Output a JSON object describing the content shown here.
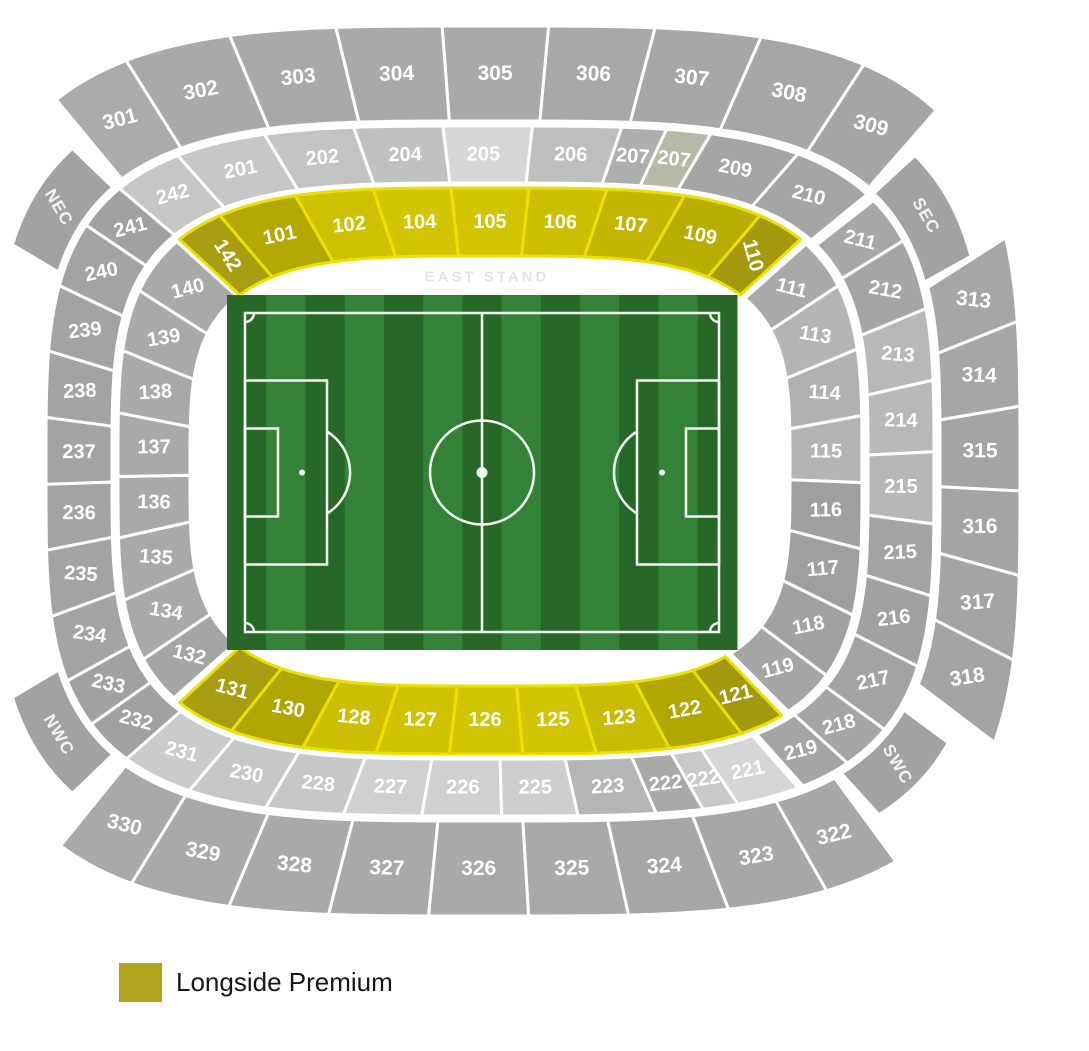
{
  "legend": {
    "label": "Longside Premium",
    "color": "#b1a31d"
  },
  "stand_label": "EAST STAND",
  "stadium": {
    "center": [
      490,
      471
    ],
    "exp": 0.55,
    "section_stroke": "#ffffff",
    "premium_stroke": "#ece000",
    "corner_color": "#a2a2a2",
    "corner_rotation": 60,
    "rings": {
      "inner": {
        "r0": [
          300,
          215
        ],
        "r1": [
          372,
          283
        ]
      },
      "middle": {
        "r0": [
          378,
          288
        ],
        "r1": [
          444,
          345
        ]
      },
      "outer": {
        "r0": [
          450,
          350
        ],
        "r1": [
          530,
          445
        ]
      },
      "corner": {
        "r0": [
          448,
          350
        ],
        "r1": [
          496,
          398
        ]
      }
    },
    "bands": [
      {
        "name": "top-outer",
        "ring": "outer",
        "t0": -134,
        "t1": -43,
        "fs": 21,
        "sections": [
          {
            "n": "301",
            "w": 0.75,
            "c": "#ababab"
          },
          {
            "n": "302",
            "w": 1,
            "c": "#a9a9a9"
          },
          {
            "n": "303",
            "w": 1,
            "c": "#a9a9a9"
          },
          {
            "n": "304",
            "w": 1,
            "c": "#a9a9a9"
          },
          {
            "n": "305",
            "w": 1,
            "c": "#a9a9a9"
          },
          {
            "n": "306",
            "w": 1,
            "c": "#a8a8a8"
          },
          {
            "n": "307",
            "w": 1,
            "c": "#a7a7a7"
          },
          {
            "n": "308",
            "w": 1,
            "c": "#a6a6a6"
          },
          {
            "n": "309",
            "w": 0.8,
            "c": "#a5a5a5"
          }
        ]
      },
      {
        "name": "right-outer",
        "ring": "outer",
        "t0": -18,
        "t1": 24,
        "fs": 21,
        "sections": [
          {
            "n": "313",
            "w": 1,
            "c": "#a6a6a6"
          },
          {
            "n": "314",
            "w": 1,
            "c": "#a6a6a6"
          },
          {
            "n": "315",
            "w": 1,
            "c": "#a4a4a4"
          },
          {
            "n": "316",
            "w": 1,
            "c": "#a4a4a4"
          },
          {
            "n": "317",
            "w": 1,
            "c": "#a4a4a4"
          },
          {
            "n": "318",
            "w": 1,
            "c": "#a4a4a4"
          }
        ]
      },
      {
        "name": "bottom-outer",
        "ring": "outer",
        "t0": 52,
        "t1": 133,
        "fs": 21,
        "sections": [
          {
            "n": "322",
            "w": 0.75,
            "c": "#a7a7a7"
          },
          {
            "n": "323",
            "w": 1,
            "c": "#a7a7a7"
          },
          {
            "n": "324",
            "w": 1,
            "c": "#a6a6a6"
          },
          {
            "n": "325",
            "w": 1,
            "c": "#a9a9a9"
          },
          {
            "n": "326",
            "w": 1,
            "c": "#a9a9a9"
          },
          {
            "n": "327",
            "w": 1,
            "c": "#a9a9a9"
          },
          {
            "n": "328",
            "w": 1,
            "c": "#a9a9a9"
          },
          {
            "n": "329",
            "w": 1,
            "c": "#a9a9a9"
          },
          {
            "n": "330",
            "w": 0.8,
            "c": "#a9a9a9"
          }
        ]
      },
      {
        "name": "top-middle",
        "ring": "middle",
        "t0": -136,
        "t1": -42,
        "fs": 20,
        "sections": [
          {
            "n": "242",
            "w": 0.75,
            "c": "#c6c6c6"
          },
          {
            "n": "201",
            "w": 1,
            "c": "#c7c7c7"
          },
          {
            "n": "202",
            "w": 1,
            "c": "#c3c3c3"
          },
          {
            "n": "204",
            "w": 1,
            "c": "#c1c1c1"
          },
          {
            "n": "205",
            "w": 1,
            "c": "#d6d6d6"
          },
          {
            "n": "206",
            "w": 1,
            "c": "#bebebe"
          },
          {
            "n": "207",
            "w": 0.5,
            "c": "#aeaeae"
          },
          {
            "n": "207",
            "w": 0.5,
            "c": "#b8b8a6"
          },
          {
            "n": "209",
            "w": 1,
            "c": "#a5a5a5"
          },
          {
            "n": "210",
            "w": 0.9,
            "c": "#a5a5a5"
          }
        ]
      },
      {
        "name": "right-middle",
        "ring": "middle",
        "t0": -40,
        "t1": 58,
        "fs": 20,
        "sections": [
          {
            "n": "211",
            "w": 0.7,
            "c": "#a7a7a7"
          },
          {
            "n": "212",
            "w": 1,
            "c": "#a5a5a5"
          },
          {
            "n": "213",
            "w": 1,
            "c": "#b8b8b8"
          },
          {
            "n": "214",
            "w": 1,
            "c": "#b8b8b8"
          },
          {
            "n": "215",
            "w": 1,
            "c": "#b6b6b6"
          },
          {
            "n": "215",
            "w": 1,
            "c": "#a3a3a3"
          },
          {
            "n": "216",
            "w": 1,
            "c": "#a1a1a1"
          },
          {
            "n": "217",
            "w": 1,
            "c": "#a3a3a3"
          },
          {
            "n": "218",
            "w": 0.7,
            "c": "#a5a5a5"
          },
          {
            "n": "219",
            "w": 0.7,
            "c": "#a5a5a5"
          }
        ]
      },
      {
        "name": "bottom-middle",
        "ring": "middle",
        "t0": 59,
        "t1": 134,
        "fs": 20,
        "sections": [
          {
            "n": "221",
            "w": 0.8,
            "c": "#d5d5d5"
          },
          {
            "n": "222",
            "w": 0.45,
            "c": "#c9c9c9"
          },
          {
            "n": "222",
            "w": 0.6,
            "c": "#a9a9a9"
          },
          {
            "n": "223",
            "w": 1,
            "c": "#b5b5b5"
          },
          {
            "n": "225",
            "w": 1,
            "c": "#cecece"
          },
          {
            "n": "226",
            "w": 1,
            "c": "#d0d0d0"
          },
          {
            "n": "227",
            "w": 1,
            "c": "#d0d0d0"
          },
          {
            "n": "228",
            "w": 1,
            "c": "#c7c7c7"
          },
          {
            "n": "230",
            "w": 1,
            "c": "#c7c7c7"
          },
          {
            "n": "231",
            "w": 0.9,
            "c": "#cbcbcb"
          }
        ]
      },
      {
        "name": "left-middle",
        "ring": "middle",
        "t0": 134,
        "t1": 224,
        "fs": 20,
        "sections": [
          {
            "n": "232",
            "w": 0.75,
            "c": "#a1a1a1"
          },
          {
            "n": "233",
            "w": 0.75,
            "c": "#a1a1a1"
          },
          {
            "n": "234",
            "w": 1,
            "c": "#a3a3a3"
          },
          {
            "n": "235",
            "w": 1,
            "c": "#a3a3a3"
          },
          {
            "n": "236",
            "w": 1,
            "c": "#a3a3a3"
          },
          {
            "n": "237",
            "w": 1,
            "c": "#a3a3a3"
          },
          {
            "n": "238",
            "w": 1,
            "c": "#a3a3a3"
          },
          {
            "n": "239",
            "w": 1,
            "c": "#a3a3a3"
          },
          {
            "n": "240",
            "w": 1,
            "c": "#a3a3a3"
          },
          {
            "n": "241",
            "w": 0.75,
            "c": "#a1a1a1"
          }
        ]
      },
      {
        "name": "left-inner",
        "ring": "inner",
        "t0": 138,
        "t1": 223,
        "fs": 20,
        "sections": [
          {
            "n": "132",
            "w": 0.8,
            "c": "#a5a5a5"
          },
          {
            "n": "134",
            "w": 1,
            "c": "#a9a9a9"
          },
          {
            "n": "135",
            "w": 1,
            "c": "#a9a9a9"
          },
          {
            "n": "136",
            "w": 1,
            "c": "#a9a9a9"
          },
          {
            "n": "137",
            "w": 1,
            "c": "#a9a9a9"
          },
          {
            "n": "138",
            "w": 1,
            "c": "#a9a9a9"
          },
          {
            "n": "139",
            "w": 1,
            "c": "#a9a9a9"
          },
          {
            "n": "140",
            "w": 1,
            "c": "#a9a9a9"
          }
        ]
      },
      {
        "name": "right-inner",
        "ring": "inner",
        "t0": -42,
        "t1": 48,
        "fs": 20,
        "sections": [
          {
            "n": "111",
            "w": 0.8,
            "c": "#a9a9a9"
          },
          {
            "n": "113",
            "w": 1,
            "c": "#b4b4b4"
          },
          {
            "n": "114",
            "w": 1,
            "c": "#b1b1b1"
          },
          {
            "n": "115",
            "w": 1,
            "c": "#b4b4b4"
          },
          {
            "n": "116",
            "w": 1,
            "c": "#9f9f9f"
          },
          {
            "n": "117",
            "w": 1,
            "c": "#9f9f9f"
          },
          {
            "n": "118",
            "w": 1,
            "c": "#a1a1a1"
          },
          {
            "n": "119",
            "w": 0.8,
            "c": "#a5a5a5"
          }
        ]
      },
      {
        "name": "top-inner-premium",
        "ring": "inner",
        "t0": -136,
        "t1": -44,
        "fs": 20,
        "premium": true,
        "sections": [
          {
            "n": "142",
            "w": 0.6,
            "c": "#a89c10",
            "r": 58
          },
          {
            "n": "101",
            "w": 1,
            "c": "#b4a800"
          },
          {
            "n": "102",
            "w": 1,
            "c": "#cdc100"
          },
          {
            "n": "104",
            "w": 1,
            "c": "#d1c500"
          },
          {
            "n": "105",
            "w": 1,
            "c": "#d1c500"
          },
          {
            "n": "106",
            "w": 1,
            "c": "#cbbf00"
          },
          {
            "n": "107",
            "w": 1,
            "c": "#c2b600"
          },
          {
            "n": "109",
            "w": 1,
            "c": "#b9ad00"
          },
          {
            "n": "110",
            "w": 0.6,
            "c": "#a3980e",
            "r": 75
          }
        ]
      },
      {
        "name": "bottom-inner-premium",
        "ring": "inner",
        "t0": 50,
        "t1": 136,
        "fs": 20,
        "premium": true,
        "sections": [
          {
            "n": "121",
            "w": 0.6,
            "c": "#a3980e"
          },
          {
            "n": "122",
            "w": 1,
            "c": "#b2a600"
          },
          {
            "n": "123",
            "w": 1,
            "c": "#c8bc00"
          },
          {
            "n": "125",
            "w": 1,
            "c": "#d1c500"
          },
          {
            "n": "126",
            "w": 1,
            "c": "#d1c500"
          },
          {
            "n": "127",
            "w": 1,
            "c": "#cfc300"
          },
          {
            "n": "128",
            "w": 1,
            "c": "#cbbf00"
          },
          {
            "n": "130",
            "w": 1,
            "c": "#b1a500"
          },
          {
            "n": "131",
            "w": 0.8,
            "c": "#a89c10"
          }
        ]
      }
    ],
    "corners": [
      {
        "label": "NEC",
        "t0": -159,
        "t1": -137
      },
      {
        "label": "SEC",
        "t0": -41,
        "t1": -19
      },
      {
        "label": "NWC",
        "t0": 137,
        "t1": 159
      },
      {
        "label": "SWC",
        "t0": 30,
        "t1": 50
      }
    ]
  },
  "pitch": {
    "x": 227,
    "y": 295,
    "w": 510,
    "h": 355,
    "stripes": 13,
    "grass_dark": "#276829",
    "grass_light": "#338237",
    "line_color": "#f2fbf2",
    "border_inset": 18
  }
}
